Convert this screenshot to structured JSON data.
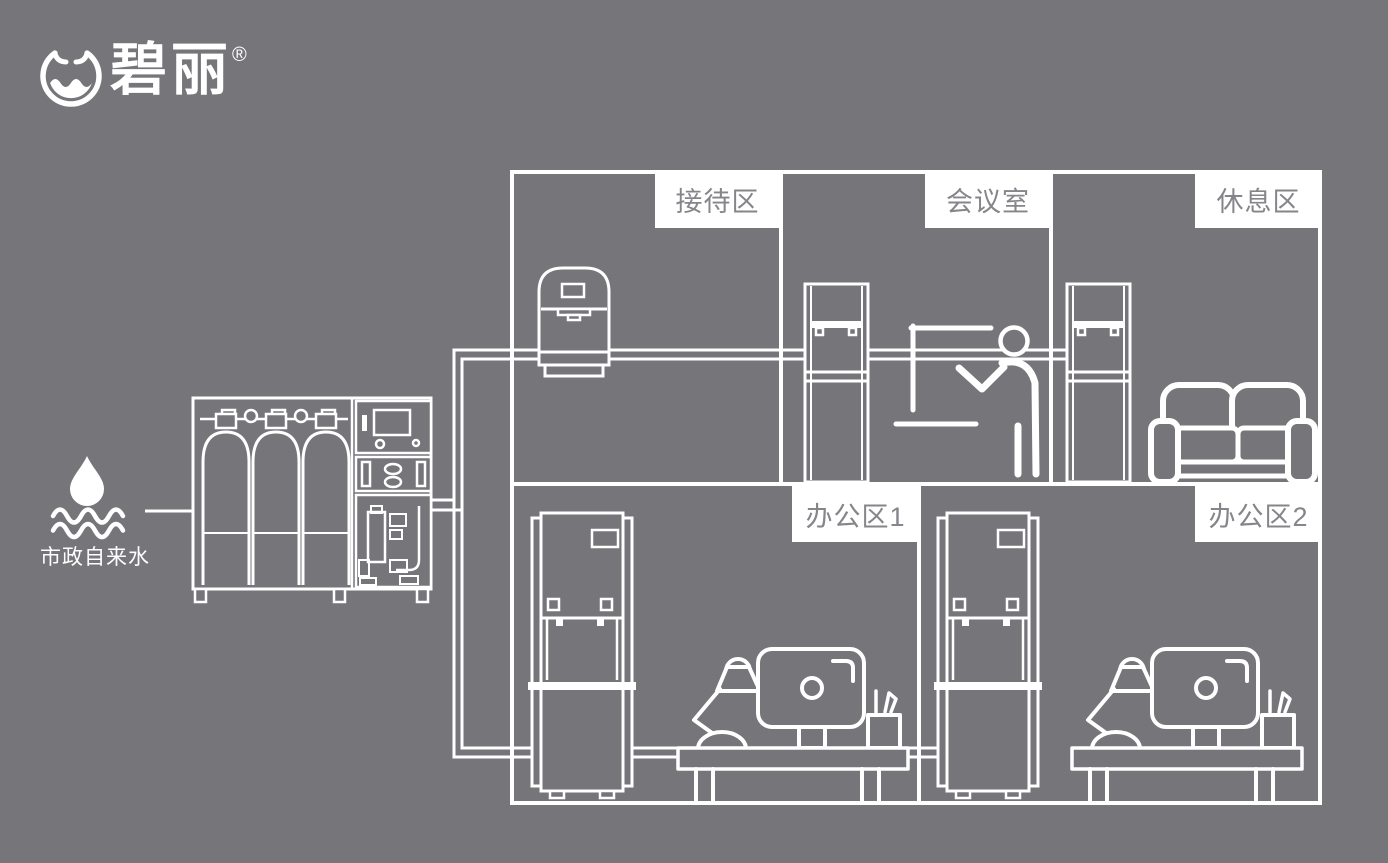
{
  "colors": {
    "background": "#76767a",
    "line": "#ffffff",
    "label_bg": "#ffffff",
    "label_text": "#85858a"
  },
  "logo": {
    "brand_name": "碧丽",
    "registered_mark": "®",
    "icon": "water-bowl-logo-icon"
  },
  "water_source": {
    "label": "市政自来水",
    "icon": "water-drop-waves-icon"
  },
  "zones": [
    {
      "id": "reception-area",
      "label": "接待区"
    },
    {
      "id": "meeting-room",
      "label": "会议室"
    },
    {
      "id": "rest-area",
      "label": "休息区"
    },
    {
      "id": "office-area-1",
      "label": "办公区1"
    },
    {
      "id": "office-area-2",
      "label": "办公区2"
    }
  ],
  "equipment": {
    "purifier": "water-purification-machine",
    "reception": "countertop-water-dispenser",
    "meeting_room": "floor-standing-water-dispenser",
    "rest_area": "floor-standing-water-dispenser",
    "office_1": "vertical-office-water-dispenser",
    "office_2": "vertical-office-water-dispenser",
    "furniture": [
      "sofa",
      "presenter-figure",
      "desk-workstation",
      "desk-workstation"
    ]
  }
}
